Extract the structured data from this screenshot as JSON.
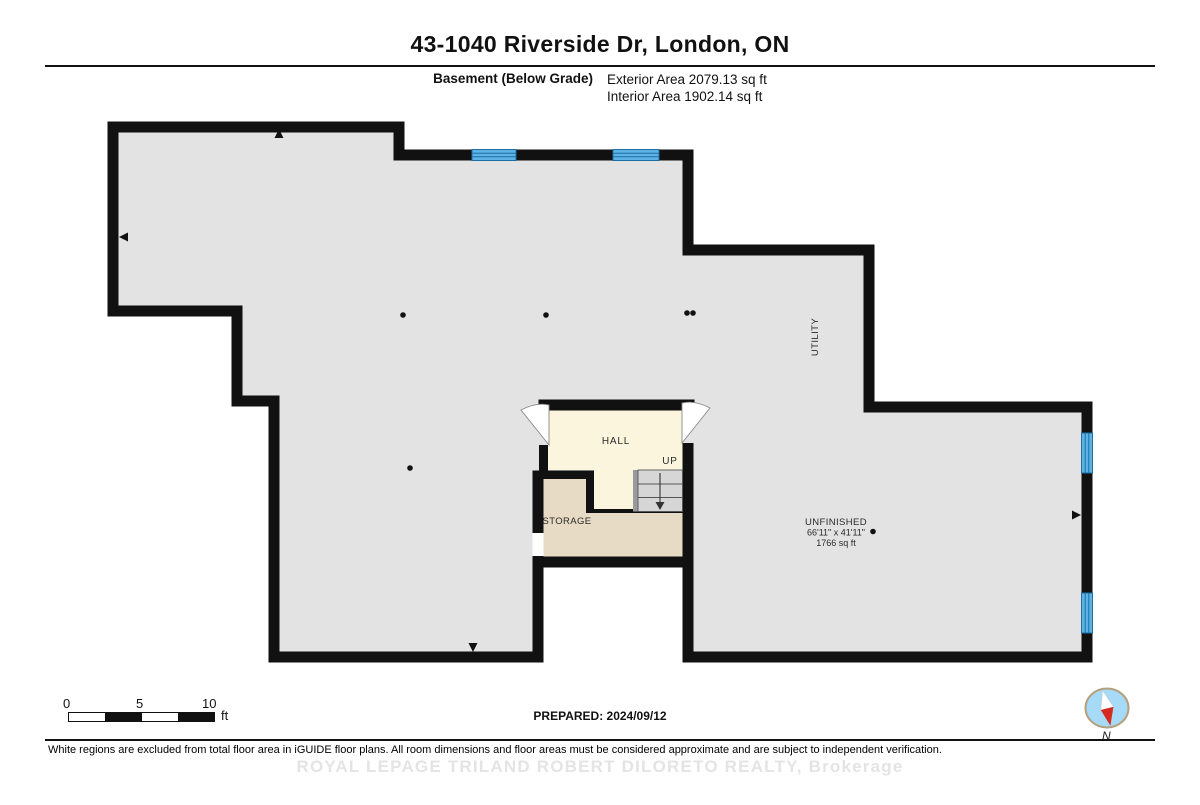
{
  "header": {
    "title": "43-1040 Riverside Dr, London, ON",
    "floor_label": "Basement (Below Grade)",
    "exterior_area": "Exterior Area 2079.13 sq ft",
    "interior_area": "Interior Area 1902.14 sq ft"
  },
  "floorplan": {
    "labels": {
      "hall": "HALL",
      "up": "UP",
      "storage": "STORAGE",
      "utility": "UTILITY",
      "unfinished_name": "UNFINISHED",
      "unfinished_dimensions": "66'11\" x 41'11\"",
      "unfinished_area": "1766 sq ft"
    },
    "colors": {
      "wall": "#111111",
      "floor_gray": "#e3e3e3",
      "hall_cream": "#fcf5dd",
      "storage_beige": "#e8dbc5",
      "stairs_gray": "#d6d6d6",
      "window_blue": "#5fb2e4",
      "window_line": "#1b6fa5",
      "compass_blue": "#a7daf6",
      "compass_red": "#d42a20"
    }
  },
  "footer": {
    "scale_ticks": [
      "0",
      "5",
      "10"
    ],
    "scale_unit": "ft",
    "prepared": "PREPARED: 2024/09/12",
    "compass_label": "N",
    "disclaimer": "White regions are excluded from total floor area in iGUIDE floor plans. All room dimensions and floor areas must be considered approximate and are subject to independent verification.",
    "watermark": "ROYAL LEPAGE TRILAND ROBERT DILORETO REALTY, Brokerage"
  }
}
